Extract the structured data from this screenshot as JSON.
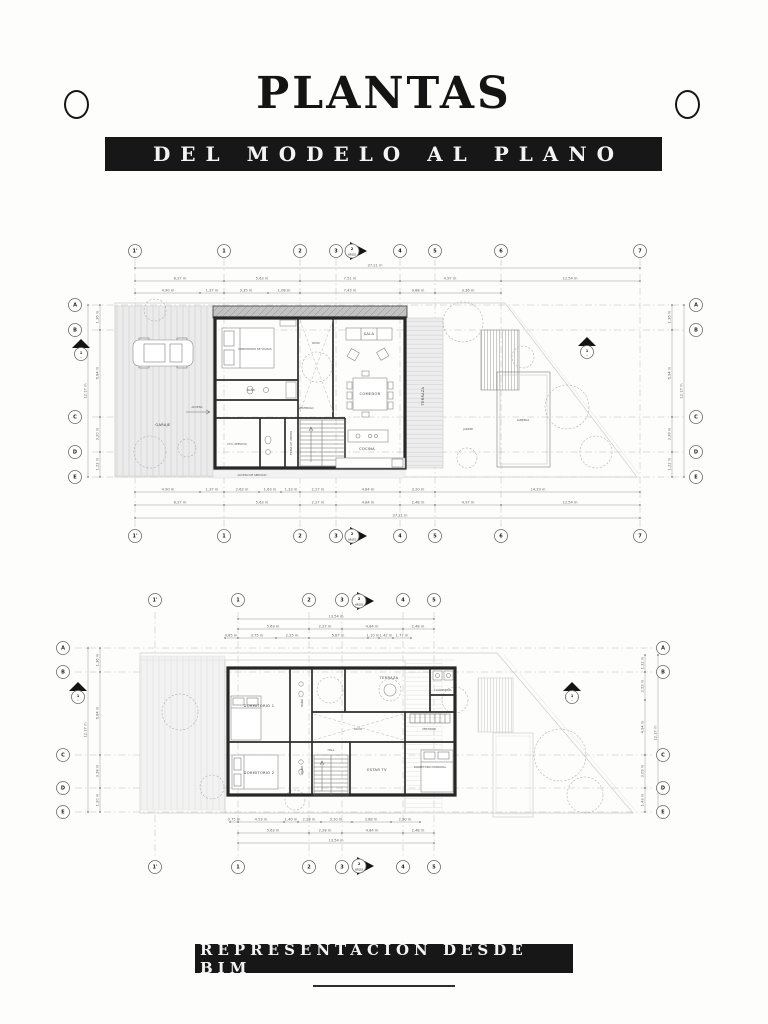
{
  "header": {
    "title": "PLANTAS",
    "subtitle": "DEL MODELO AL PLANO"
  },
  "footer": {
    "banner": "REPRESENTACIÓN DESDE BIM"
  },
  "plan1": {
    "grid_cols": [
      "1'",
      "1",
      "2",
      "3",
      "4",
      "5",
      "6",
      "7"
    ],
    "grid_rows": [
      "A",
      "B",
      "C",
      "D",
      "E"
    ],
    "section_markers": {
      "horizontal": {
        "number": "2",
        "sheet": "ARQ02"
      },
      "vertical": {
        "number": "1",
        "sheet": "—"
      }
    },
    "rooms": {
      "garaje": "GARAJE",
      "dormitorio_visitas": "DORMITORIO DE VISITAS",
      "bano": "BAÑO",
      "patio": "PATIO",
      "sala": "SALA",
      "comedor": "COMEDOR",
      "cocina": "COCINA",
      "cto_servicio": "CTO. SERVICIO",
      "estar_visitas": "ESTAR DE VISITAS",
      "vestibulo": "VESTÍBULO",
      "acceso": "ACCESO",
      "acceso_servicio": "ACCESO DE SERVICIO",
      "terraza": "TERRAZA",
      "jardin": "JARDÍN",
      "alberca": "ALBERCA"
    },
    "dims": {
      "top_overall": "37.21 m",
      "top_major": [
        "6.27 m",
        "5.63 m",
        "7.51 m",
        "4.97 m",
        "12.54 m"
      ],
      "top_minor": [
        "4.90 m",
        "1.37 m",
        "3.35 m",
        "1.08 m",
        "7.43 m",
        "0.88 m",
        "3.36 m"
      ],
      "bottom_minor": [
        "4.90 m",
        "1.37 m",
        "2.63 m",
        "1.63 m",
        "1.33 m",
        "2.27 m",
        "4.84 m",
        "3.20 m",
        "14.29 m"
      ],
      "bottom_major": [
        "6.27 m",
        "5.63 m",
        "2.27 m",
        "4.84 m",
        "2.48 m",
        "4.97 m",
        "12.54 m"
      ],
      "bottom_overall": "37.21 m",
      "left": [
        "1.36 m",
        "6.84 m",
        "3.20 m",
        "1.22 m"
      ],
      "left_overall": "12.17 m",
      "right": [
        "1.36 m",
        "6.94 m",
        "3.28 m",
        "1.22 m"
      ],
      "right_overall": "12.17 m"
    }
  },
  "plan2": {
    "grid_cols": [
      "1'",
      "1",
      "2",
      "3",
      "4",
      "5"
    ],
    "grid_rows": [
      "A",
      "B",
      "C",
      "D",
      "E"
    ],
    "section_markers": {
      "horizontal": {
        "number": "2",
        "sheet": "ARQ02"
      },
      "vertical": {
        "number": "1",
        "sheet": "—"
      }
    },
    "rooms": {
      "dormitorio1": "DORMITORIO 1",
      "dormitorio2": "DORMITORIO 2",
      "dormitorio_principal": "DORMITORIO PRINCIPAL",
      "bano1": "BAÑO",
      "bano2": "BAÑO",
      "hall": "HALL",
      "estar_tv": "ESTAR TV",
      "terraza": "TERRAZA",
      "vestidor": "VESTIDOR",
      "lavanderia": "LAVANDERÍA",
      "vacio": "VACÍO"
    },
    "dims": {
      "top_overall": "13.54 m",
      "top_major": [
        "5.63 m",
        "2.27 m",
        "4.84 m",
        "2.48 m"
      ],
      "top_minor": [
        "0.85 m",
        "3.75 m",
        "2.25 m",
        "5.87 m",
        "1.10 m",
        "1.42 m",
        "1.77 m"
      ],
      "bottom_minor": [
        "0.75 m",
        "4.53 m",
        "1.40 m",
        "2.28 m",
        "3.10 m",
        "3.88 m",
        "2.90 m"
      ],
      "bottom_major": [
        "5.63 m",
        "2.28 m",
        "4.84 m",
        "2.48 m"
      ],
      "bottom_overall": "13.54 m",
      "left": [
        "1.36 m",
        "6.84 m",
        "3.28 m",
        "1.20 m"
      ],
      "left_overall": "12.17 m",
      "right": [
        "1.32 m",
        "2.53 m",
        "4.94 m",
        "3.09 m",
        "1.43 m"
      ],
      "right_overall": "12.17 m"
    }
  }
}
